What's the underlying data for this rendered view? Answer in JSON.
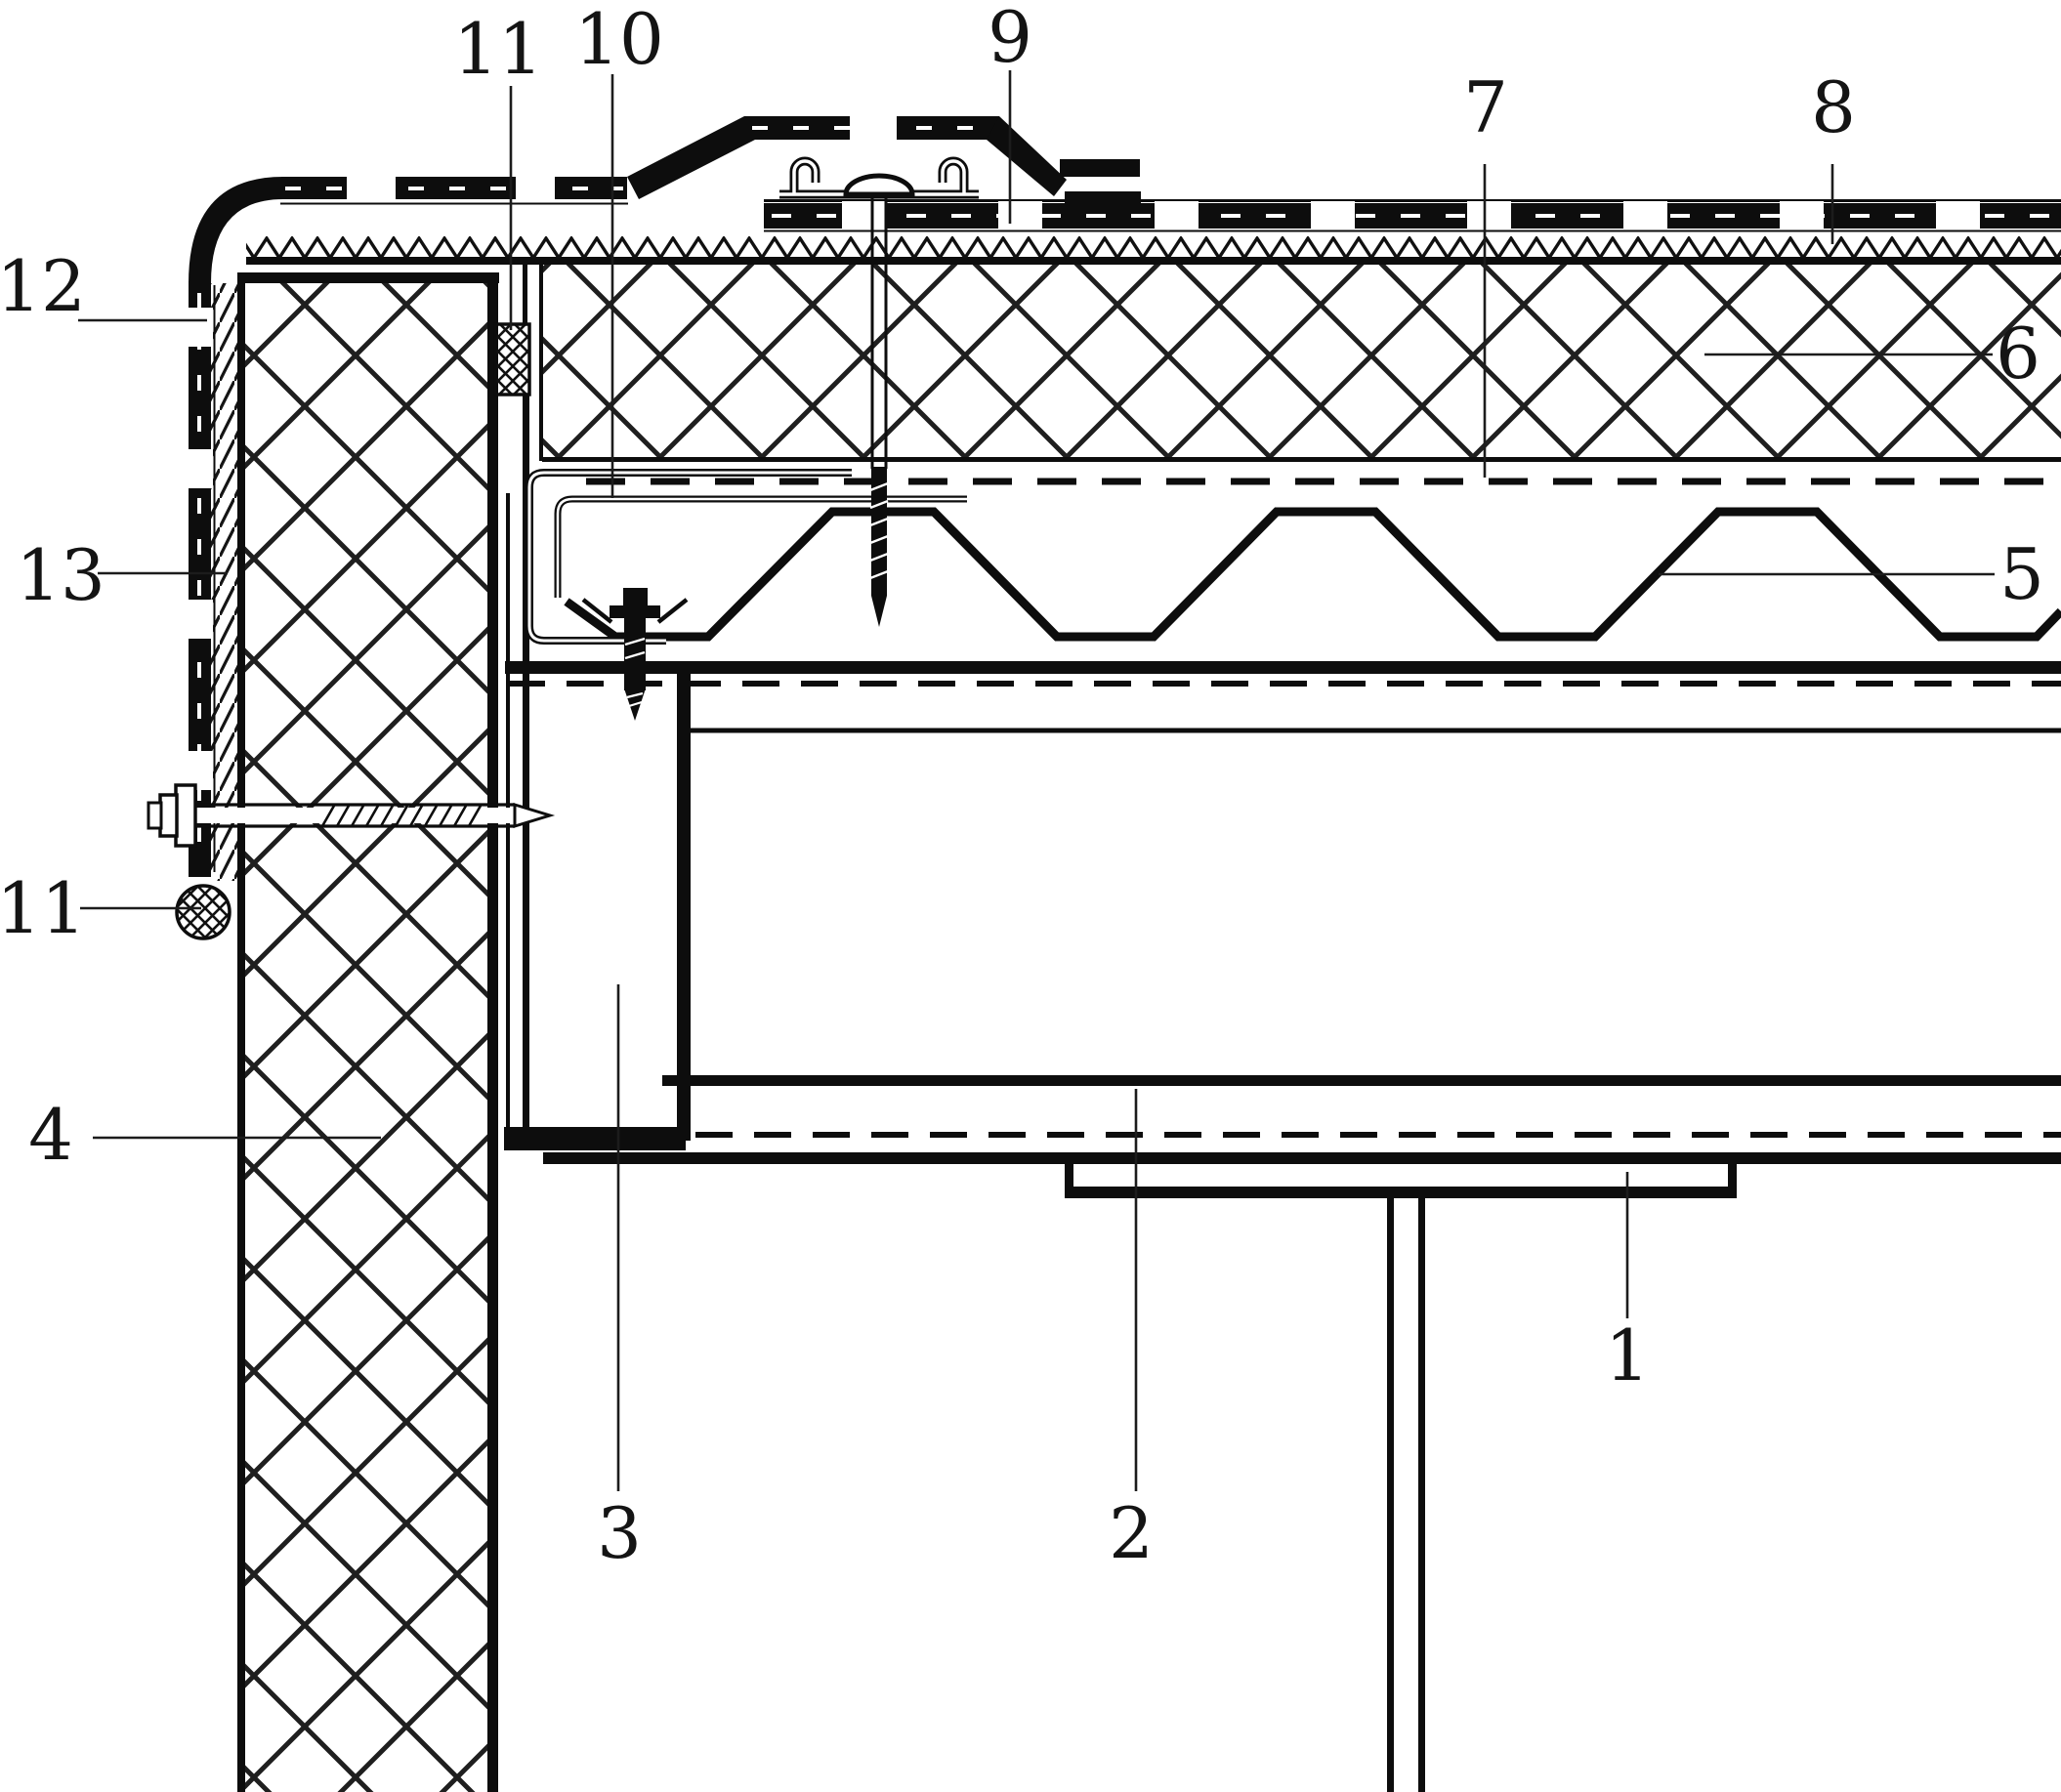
{
  "drawing": {
    "background_color": "#ffffff",
    "line_color": "#0d0d0d",
    "callouts": {
      "c1": {
        "text": "1"
      },
      "c2": {
        "text": "2"
      },
      "c3": {
        "text": "3"
      },
      "c4": {
        "text": "4"
      },
      "c5": {
        "text": "5"
      },
      "c6": {
        "text": "6"
      },
      "c7": {
        "text": "7"
      },
      "c8": {
        "text": "8"
      },
      "c9": {
        "text": "9"
      },
      "c10": {
        "text": "10"
      },
      "c11_top": {
        "text": "11"
      },
      "c11_left": {
        "text": "11"
      },
      "c12": {
        "text": "12"
      },
      "c13": {
        "text": "13"
      }
    }
  }
}
